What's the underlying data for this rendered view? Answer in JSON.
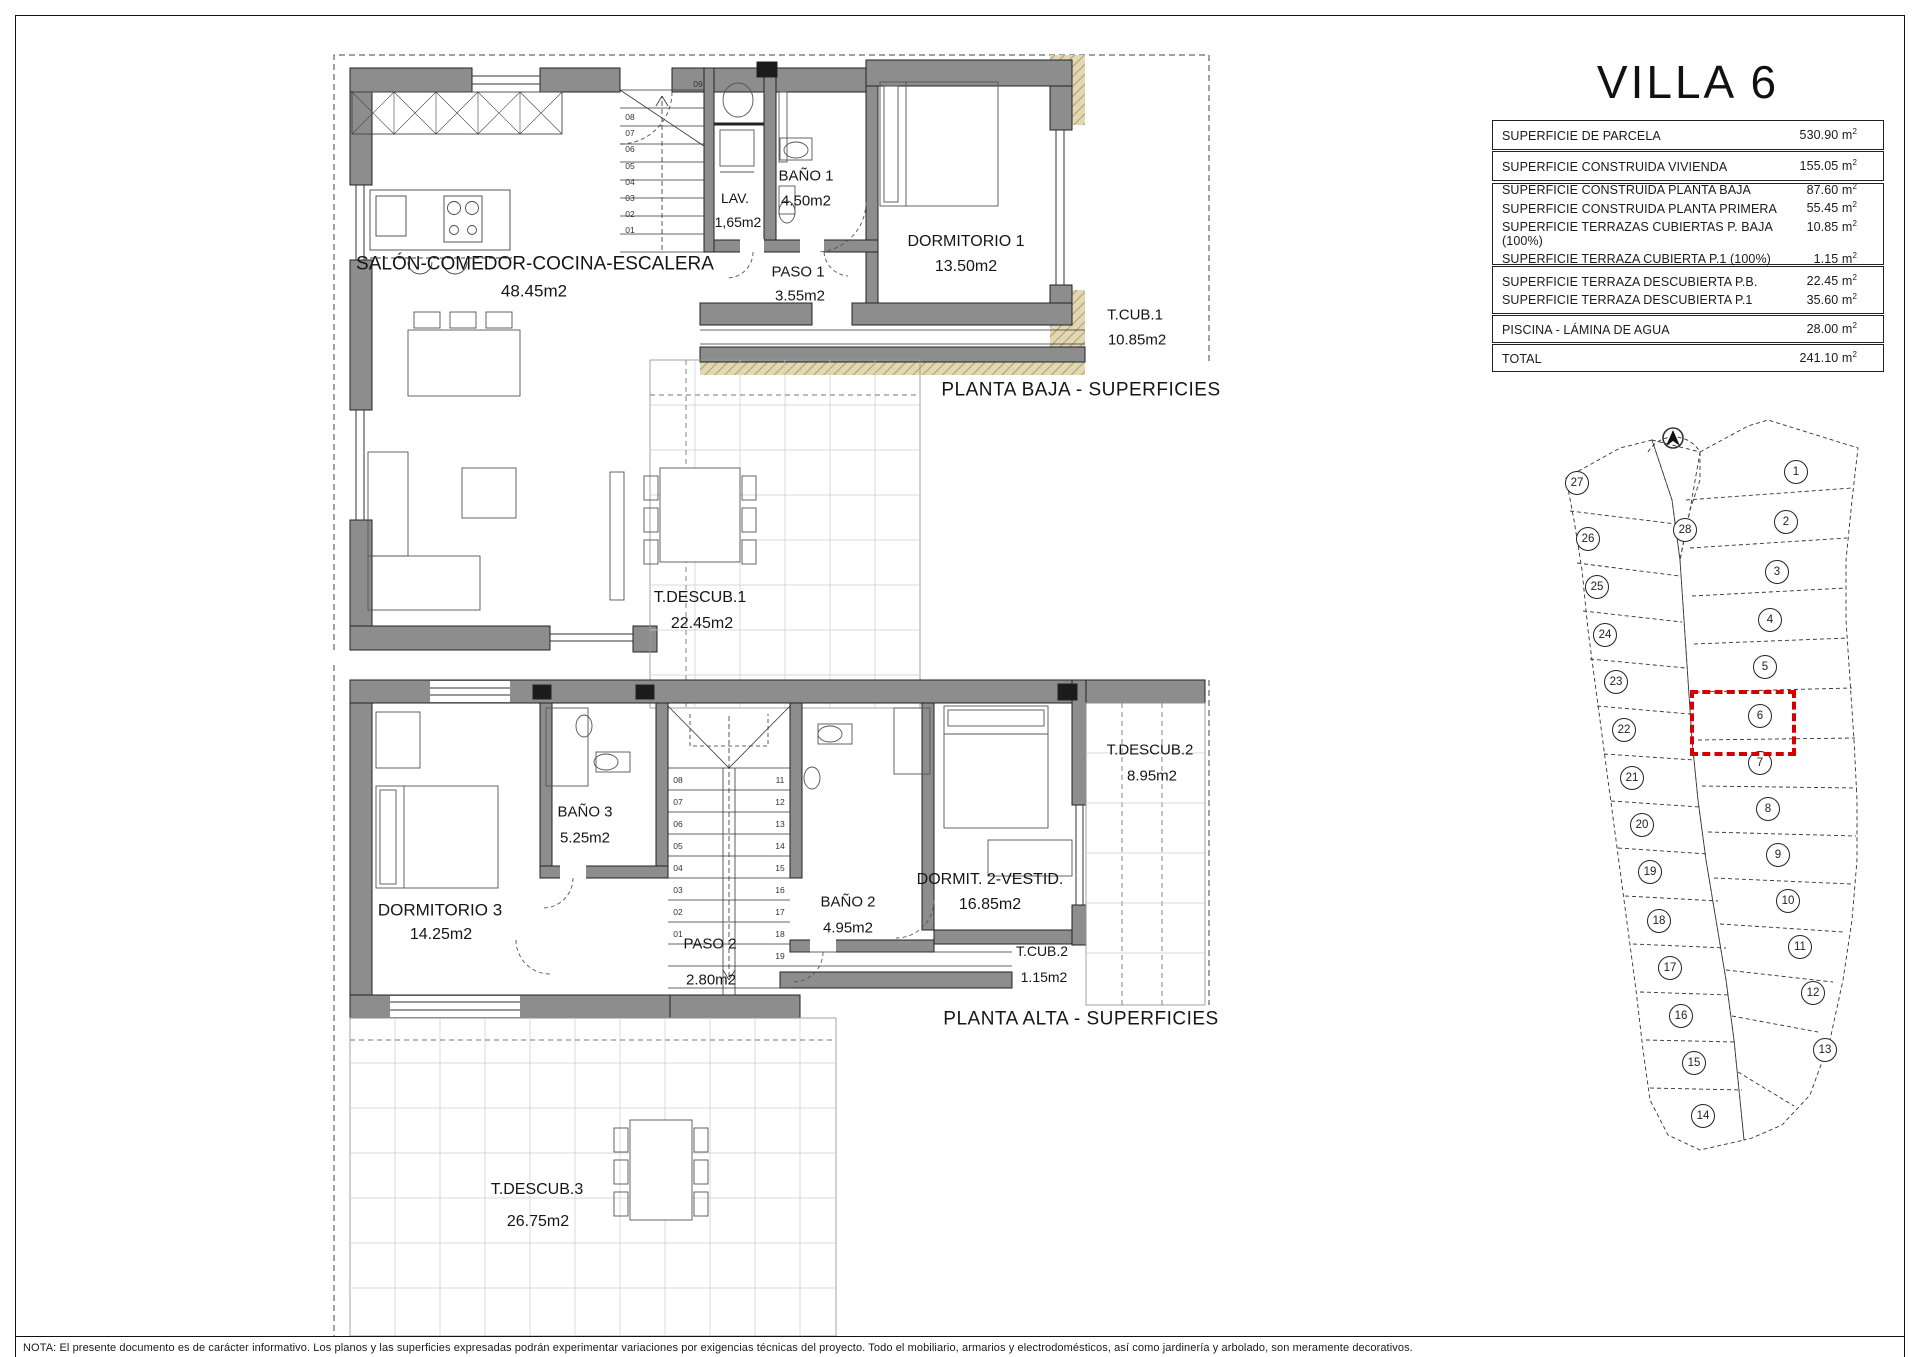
{
  "title": "VILLA 6",
  "footer": {
    "note": "NOTA: El presente documento es de carácter informativo. Los planos y las superficies expresadas podrán experimentar variaciones por exigencias técnicas del proyecto. Todo el mobiliario, armarios y electrodomésticos, así como jardinería y arbolado, son meramente decorativos."
  },
  "surface_table": {
    "unit_base": "m",
    "unit_exp": "2",
    "groups": [
      {
        "rows": [
          {
            "label": "SUPERFICIE DE PARCELA",
            "value": "530.90"
          }
        ]
      },
      {
        "rows": [
          {
            "label": "SUPERFICIE CONSTRUIDA VIVIENDA",
            "value": "155.05"
          }
        ]
      },
      {
        "rows": [
          {
            "label": "SUPERFICIE CONSTRUIDA PLANTA BAJA",
            "value": "87.60"
          },
          {
            "label": "SUPERFICIE CONSTRUIDA PLANTA PRIMERA",
            "value": "55.45"
          },
          {
            "label": "SUPERFICIE TERRAZAS CUBIERTAS P. BAJA (100%)",
            "value": "10.85"
          },
          {
            "label": "SUPERFICIE TERRAZA CUBIERTA P.1 (100%)",
            "value": "1.15"
          }
        ]
      },
      {
        "rows": [
          {
            "label": "SUPERFICIE TERRAZA DESCUBIERTA P.B.",
            "value": "22.45"
          },
          {
            "label": "SUPERFICIE TERRAZA DESCUBIERTA P.1",
            "value": "35.60"
          }
        ]
      },
      {
        "rows": [
          {
            "label": "PISCINA - LÁMINA DE AGUA",
            "value": "28.00"
          }
        ]
      },
      {
        "rows": [
          {
            "label": "TOTAL",
            "value": "241.10"
          }
        ]
      }
    ]
  },
  "ground_floor": {
    "caption": "PLANTA BAJA - SUPERFICIES",
    "rooms": [
      {
        "name": "SALÓN-COMEDOR-COCINA-ESCALERA",
        "area": "48.45m2"
      },
      {
        "name": "LAV.",
        "area": "1,65m2"
      },
      {
        "name": "BAÑO 1",
        "area": "4.50m2"
      },
      {
        "name": "PASO 1",
        "area": "3.55m2"
      },
      {
        "name": "DORMITORIO 1",
        "area": "13.50m2"
      },
      {
        "name": "T.CUB.1",
        "area": "10.85m2"
      },
      {
        "name": "T.DESCUB.1",
        "area": "22.45m2"
      }
    ]
  },
  "upper_floor": {
    "caption": "PLANTA ALTA - SUPERFICIES",
    "rooms": [
      {
        "name": "DORMITORIO 3",
        "area": "14.25m2"
      },
      {
        "name": "BAÑO 3",
        "area": "5.25m2"
      },
      {
        "name": "PASO 2",
        "area": "2.80m2"
      },
      {
        "name": "BAÑO 2",
        "area": "4.95m2"
      },
      {
        "name": "DORMIT. 2-VESTID.",
        "area": "16.85m2"
      },
      {
        "name": "T.CUB.2",
        "area": "1.15m2"
      },
      {
        "name": "T.DESCUB.2",
        "area": "8.95m2"
      },
      {
        "name": "T.DESCUB.3",
        "area": "26.75m2"
      }
    ]
  },
  "stairs": {
    "ground_top": "09",
    "ground": [
      "01",
      "02",
      "03",
      "04",
      "05",
      "06",
      "07",
      "08"
    ],
    "upper_left": [
      "08",
      "07",
      "06",
      "05",
      "04",
      "03",
      "02",
      "01"
    ],
    "upper_right": [
      "11",
      "12",
      "13",
      "14",
      "15",
      "16",
      "17",
      "18",
      "19"
    ]
  },
  "site_plan": {
    "highlighted_plot": "6",
    "highlight_color": "#d40000",
    "plots": [
      {
        "n": "1",
        "x": 1796,
        "y": 472
      },
      {
        "n": "2",
        "x": 1786,
        "y": 522
      },
      {
        "n": "3",
        "x": 1777,
        "y": 572
      },
      {
        "n": "4",
        "x": 1770,
        "y": 620
      },
      {
        "n": "5",
        "x": 1765,
        "y": 667
      },
      {
        "n": "6",
        "x": 1760,
        "y": 716
      },
      {
        "n": "7",
        "x": 1760,
        "y": 763
      },
      {
        "n": "8",
        "x": 1768,
        "y": 809
      },
      {
        "n": "9",
        "x": 1778,
        "y": 855
      },
      {
        "n": "10",
        "x": 1788,
        "y": 901
      },
      {
        "n": "11",
        "x": 1800,
        "y": 947
      },
      {
        "n": "12",
        "x": 1813,
        "y": 993
      },
      {
        "n": "13",
        "x": 1825,
        "y": 1050
      },
      {
        "n": "14",
        "x": 1703,
        "y": 1116
      },
      {
        "n": "15",
        "x": 1694,
        "y": 1063
      },
      {
        "n": "16",
        "x": 1681,
        "y": 1016
      },
      {
        "n": "17",
        "x": 1670,
        "y": 968
      },
      {
        "n": "18",
        "x": 1659,
        "y": 921
      },
      {
        "n": "19",
        "x": 1650,
        "y": 872
      },
      {
        "n": "20",
        "x": 1642,
        "y": 825
      },
      {
        "n": "21",
        "x": 1632,
        "y": 778
      },
      {
        "n": "22",
        "x": 1624,
        "y": 730
      },
      {
        "n": "23",
        "x": 1616,
        "y": 682
      },
      {
        "n": "24",
        "x": 1605,
        "y": 635
      },
      {
        "n": "25",
        "x": 1597,
        "y": 587
      },
      {
        "n": "26",
        "x": 1588,
        "y": 539
      },
      {
        "n": "27",
        "x": 1577,
        "y": 483
      },
      {
        "n": "28",
        "x": 1685,
        "y": 530
      }
    ]
  }
}
